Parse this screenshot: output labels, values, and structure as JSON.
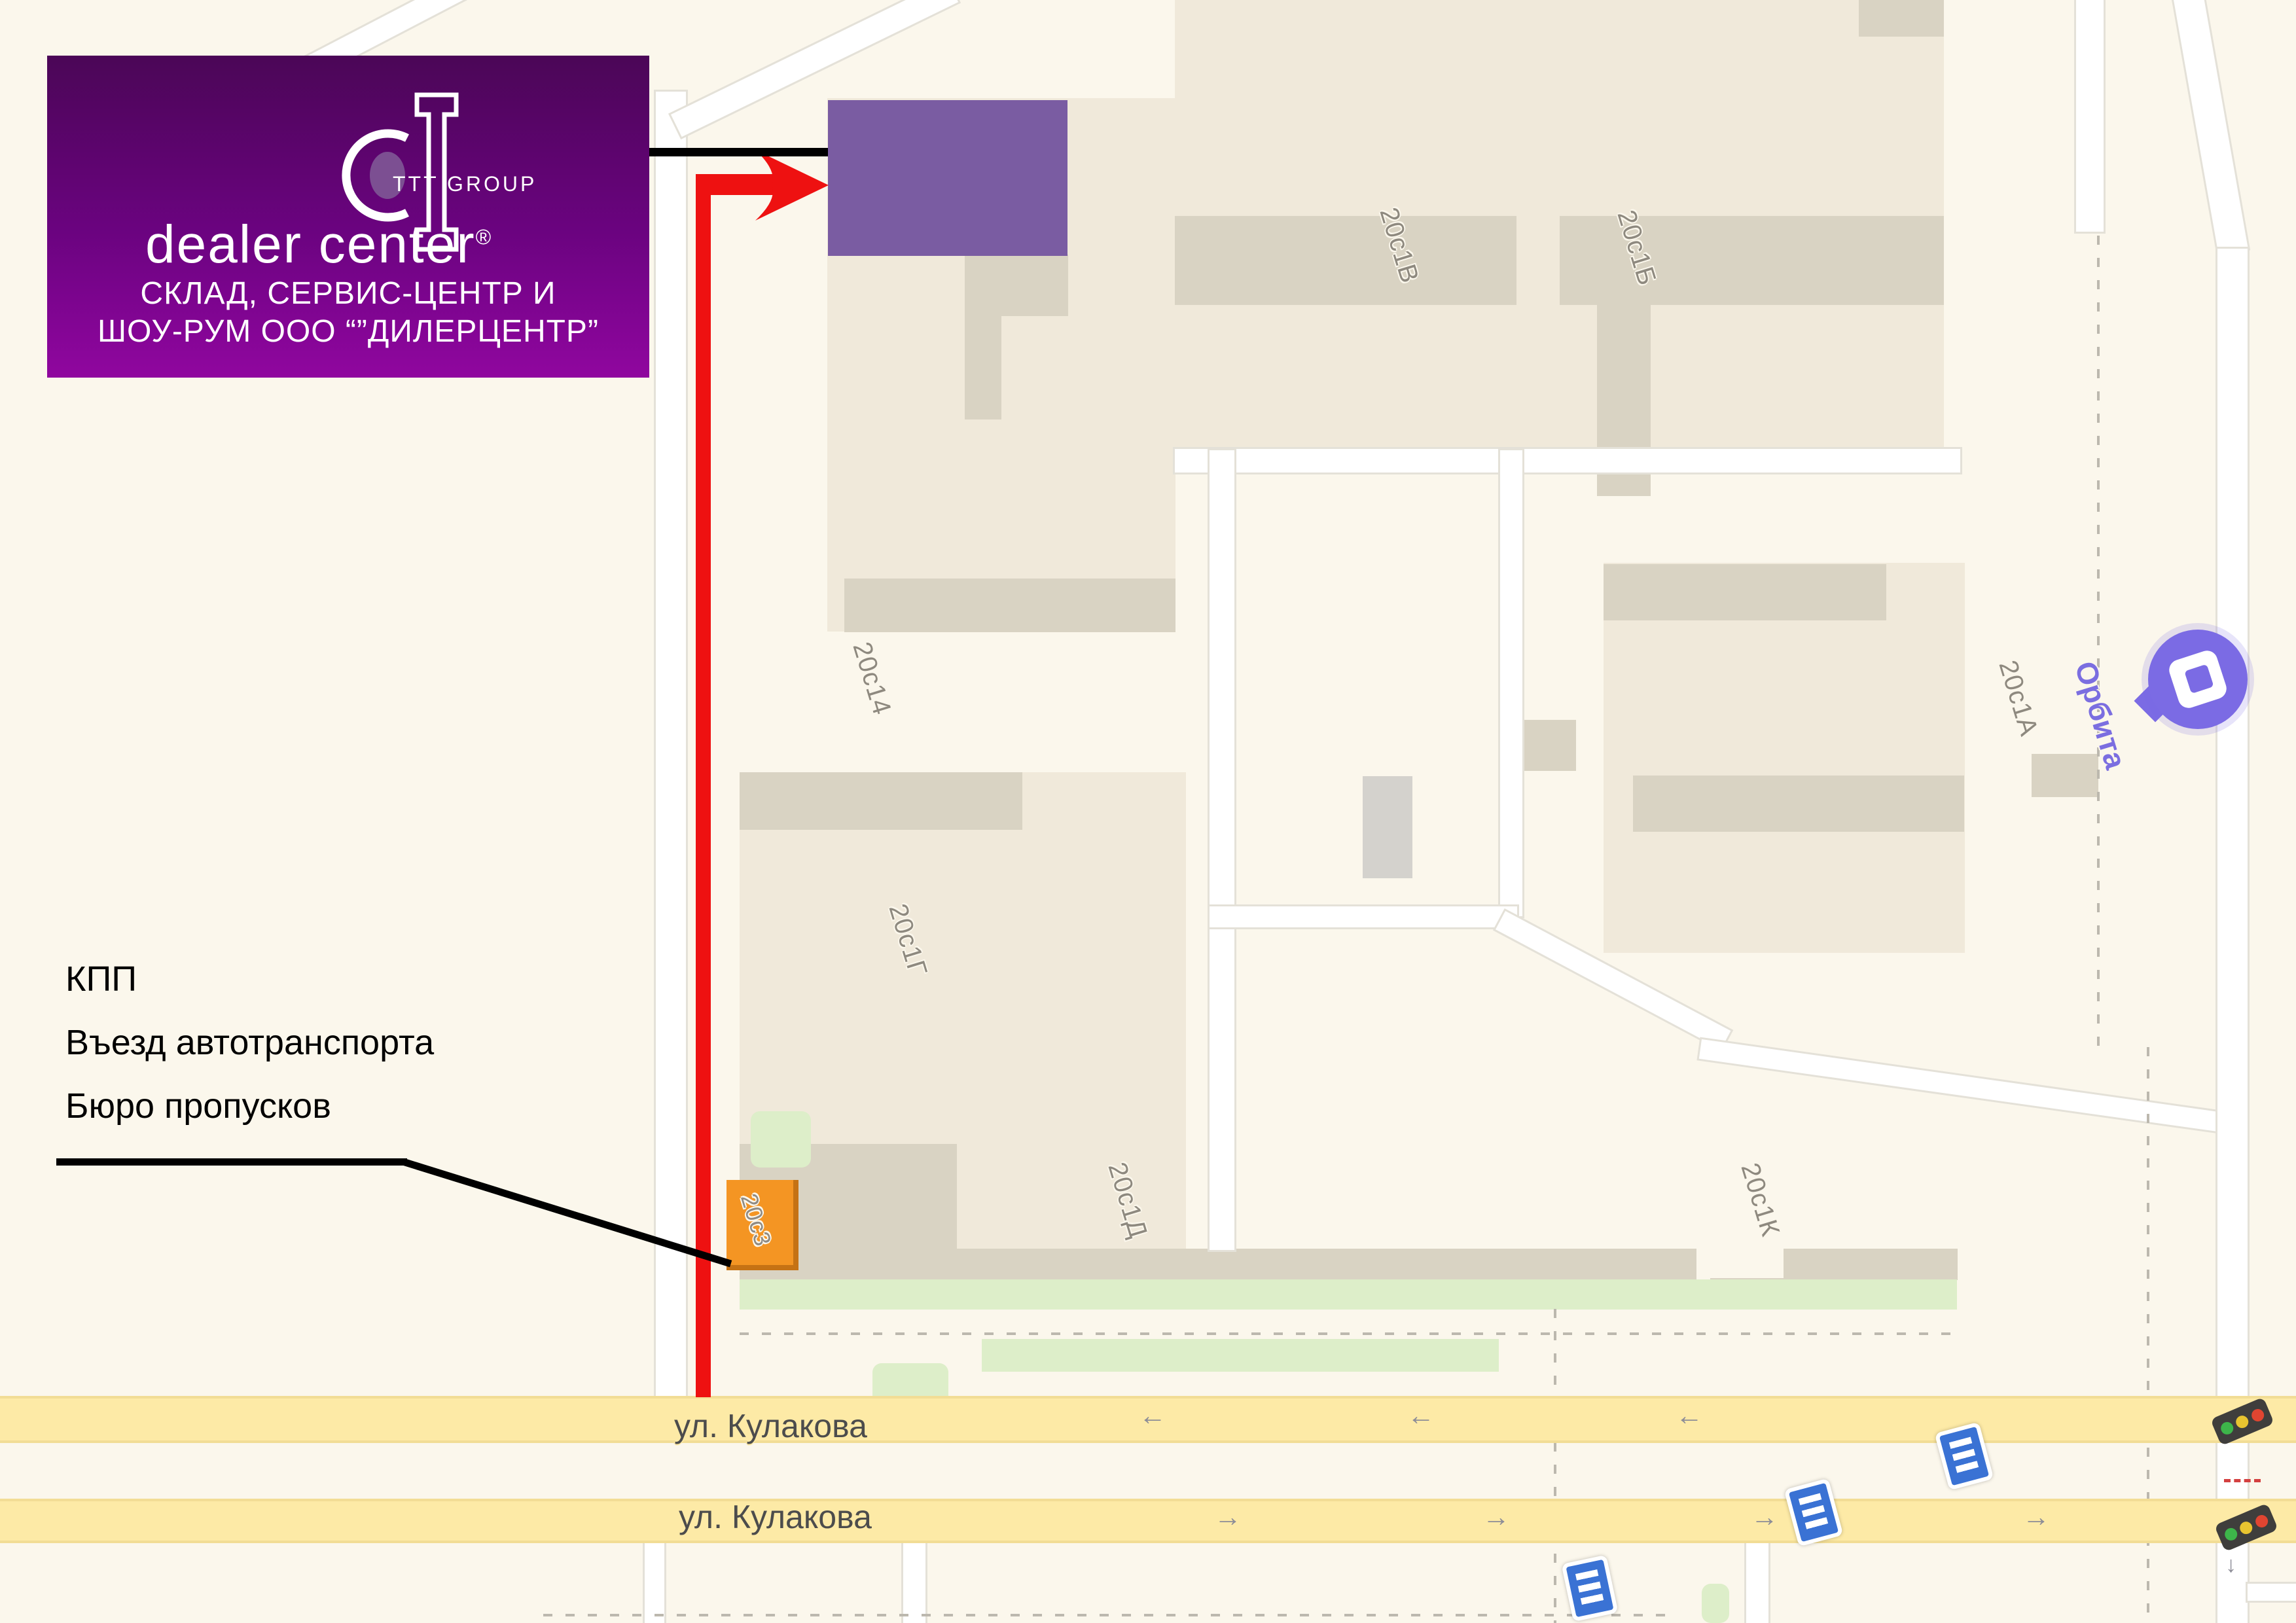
{
  "logo": {
    "group": "TTT GROUP",
    "brand": "dealer center",
    "registered": "®",
    "tagline_line1": "СКЛАД, СЕРВИС-ЦЕНТР И",
    "tagline_line2": "ШОУ-РУМ ООО “”ДИЛЕРЦЕНТР”"
  },
  "kpp": {
    "line1": "КПП",
    "line2": "Въезд автотранспорта",
    "line3": "Бюро пропусков"
  },
  "map": {
    "building_labels": [
      {
        "text": "20с1В"
      },
      {
        "text": "20с1Б"
      },
      {
        "text": "20с14"
      },
      {
        "text": "20с1А"
      },
      {
        "text": "20с1Г"
      },
      {
        "text": "20с1Д"
      },
      {
        "text": "20с1К"
      },
      {
        "text": "20с3"
      }
    ],
    "poi": {
      "name": "Орбита"
    },
    "streets": [
      {
        "name": "ул. Кулакова"
      },
      {
        "name": "ул. Кулакова"
      }
    ],
    "road_arrows": {
      "left": "←",
      "right": "→",
      "down": "↓"
    },
    "colors": {
      "background": "#fbf7ec",
      "building": "#f0e9da",
      "building_shadow": "#d9d3c3",
      "yellow_road": "#fdeaa6",
      "route_red": "#ee1111",
      "destination_purple": "#7a5ca2",
      "logo_gradient_top": "#4b0657",
      "logo_gradient_bottom": "#90069f",
      "orange_building": "#f49523",
      "poi_purple": "#7b6be4",
      "transport_sign_blue": "#3a72d4",
      "green_area": "#ddeec9"
    }
  }
}
